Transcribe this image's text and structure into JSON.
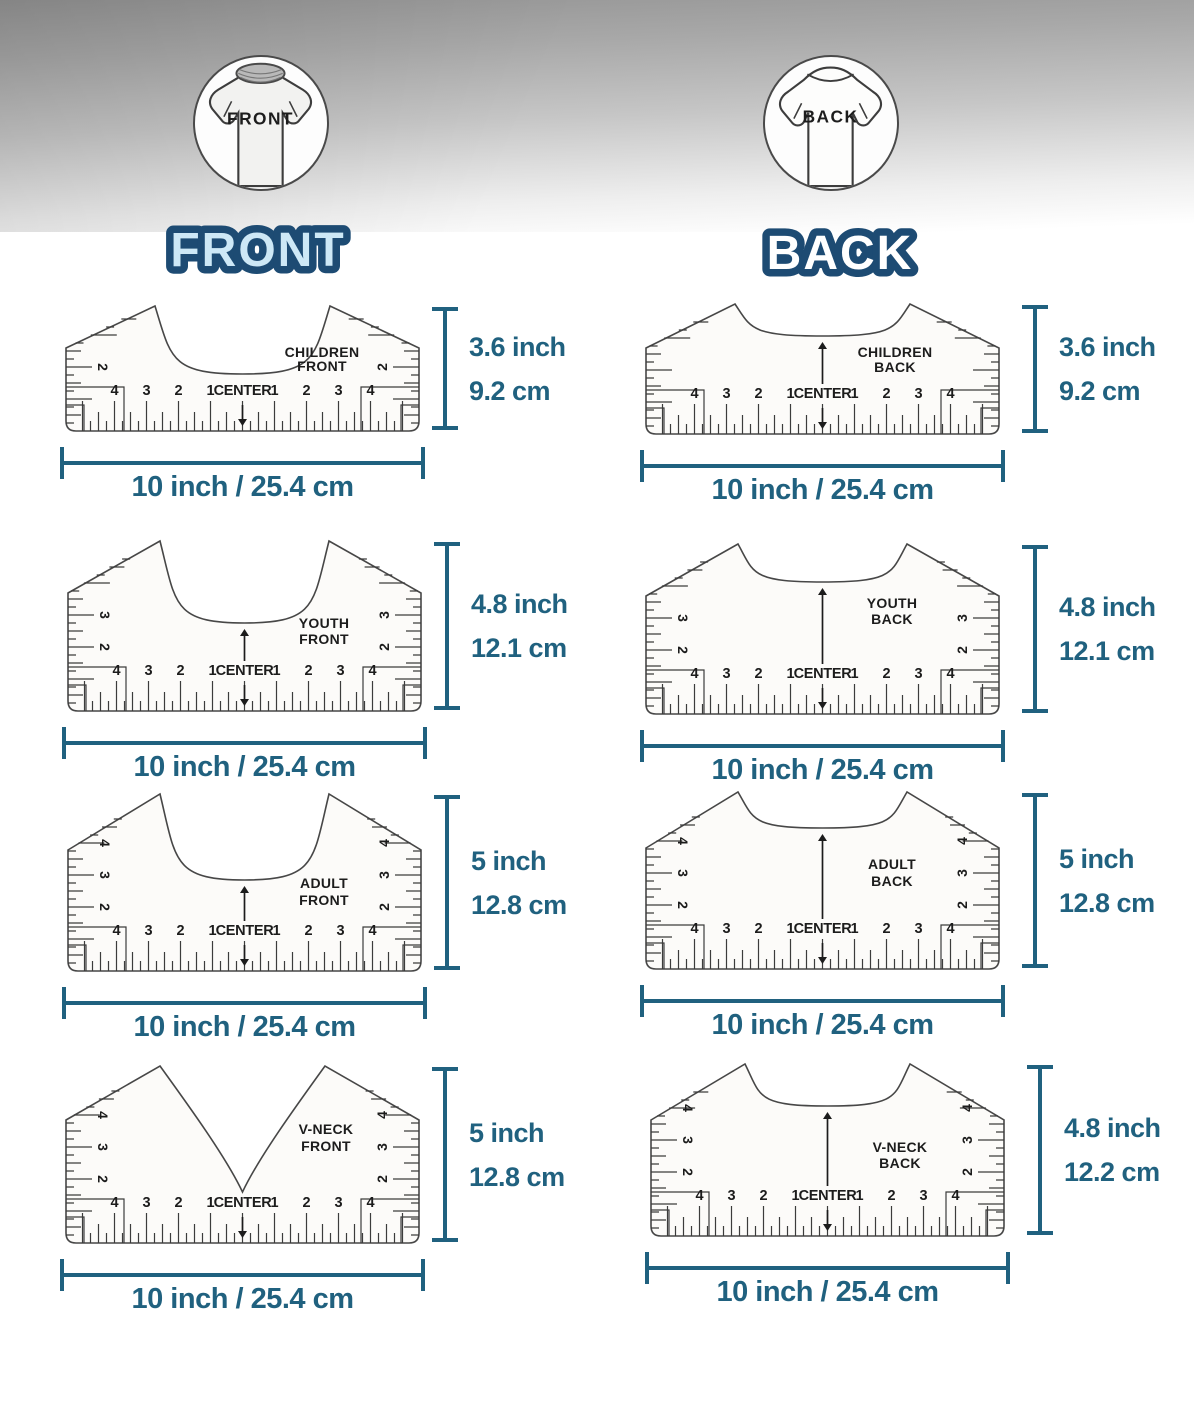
{
  "header": {
    "front_badge": "FRONT",
    "back_badge": "BACK",
    "front_title": "FRONT",
    "back_title": "BACK"
  },
  "colors": {
    "accent": "#20617f",
    "title_outline": "#1d4b73",
    "front_title_fill": "#cde8f6",
    "back_title_fill": "#ffffff",
    "ruler_line": "#3c3c3c"
  },
  "shared": {
    "width_label": "10 inch / 25.4 cm",
    "center_label": "CENTER",
    "bottom_numbers_left": [
      "4",
      "3",
      "2",
      "1"
    ],
    "bottom_numbers_right": [
      "1",
      "2",
      "3",
      "4"
    ]
  },
  "rulers": [
    {
      "id": "children-front",
      "name_line1": "CHILDREN",
      "name_line2": "FRONT",
      "height_in": "3.6 inch",
      "height_cm": "9.2 cm",
      "side_numbers": [
        "2"
      ]
    },
    {
      "id": "youth-front",
      "name_line1": "YOUTH",
      "name_line2": "FRONT",
      "height_in": "4.8 inch",
      "height_cm": "12.1 cm",
      "side_numbers": [
        "3",
        "2"
      ]
    },
    {
      "id": "adult-front",
      "name_line1": "ADULT",
      "name_line2": "FRONT",
      "height_in": "5 inch",
      "height_cm": "12.8 cm",
      "side_numbers": [
        "4",
        "3",
        "2"
      ]
    },
    {
      "id": "vneck-front",
      "name_line1": "V-NECK",
      "name_line2": "FRONT",
      "height_in": "5 inch",
      "height_cm": "12.8 cm",
      "side_numbers": [
        "4",
        "3",
        "2"
      ]
    },
    {
      "id": "children-back",
      "name_line1": "CHILDREN",
      "name_line2": "BACK",
      "height_in": "3.6 inch",
      "height_cm": "9.2 cm",
      "side_numbers": []
    },
    {
      "id": "youth-back",
      "name_line1": "YOUTH",
      "name_line2": "BACK",
      "height_in": "4.8 inch",
      "height_cm": "12.1 cm",
      "side_numbers": [
        "3",
        "2"
      ]
    },
    {
      "id": "adult-back",
      "name_line1": "ADULT",
      "name_line2": "BACK",
      "height_in": "5 inch",
      "height_cm": "12.8 cm",
      "side_numbers": [
        "4",
        "3",
        "2"
      ]
    },
    {
      "id": "vneck-back",
      "name_line1": "V-NECK",
      "name_line2": "BACK",
      "height_in": "4.8 inch",
      "height_cm": "12.2 cm",
      "side_numbers": [
        "4",
        "3",
        "2"
      ]
    }
  ]
}
